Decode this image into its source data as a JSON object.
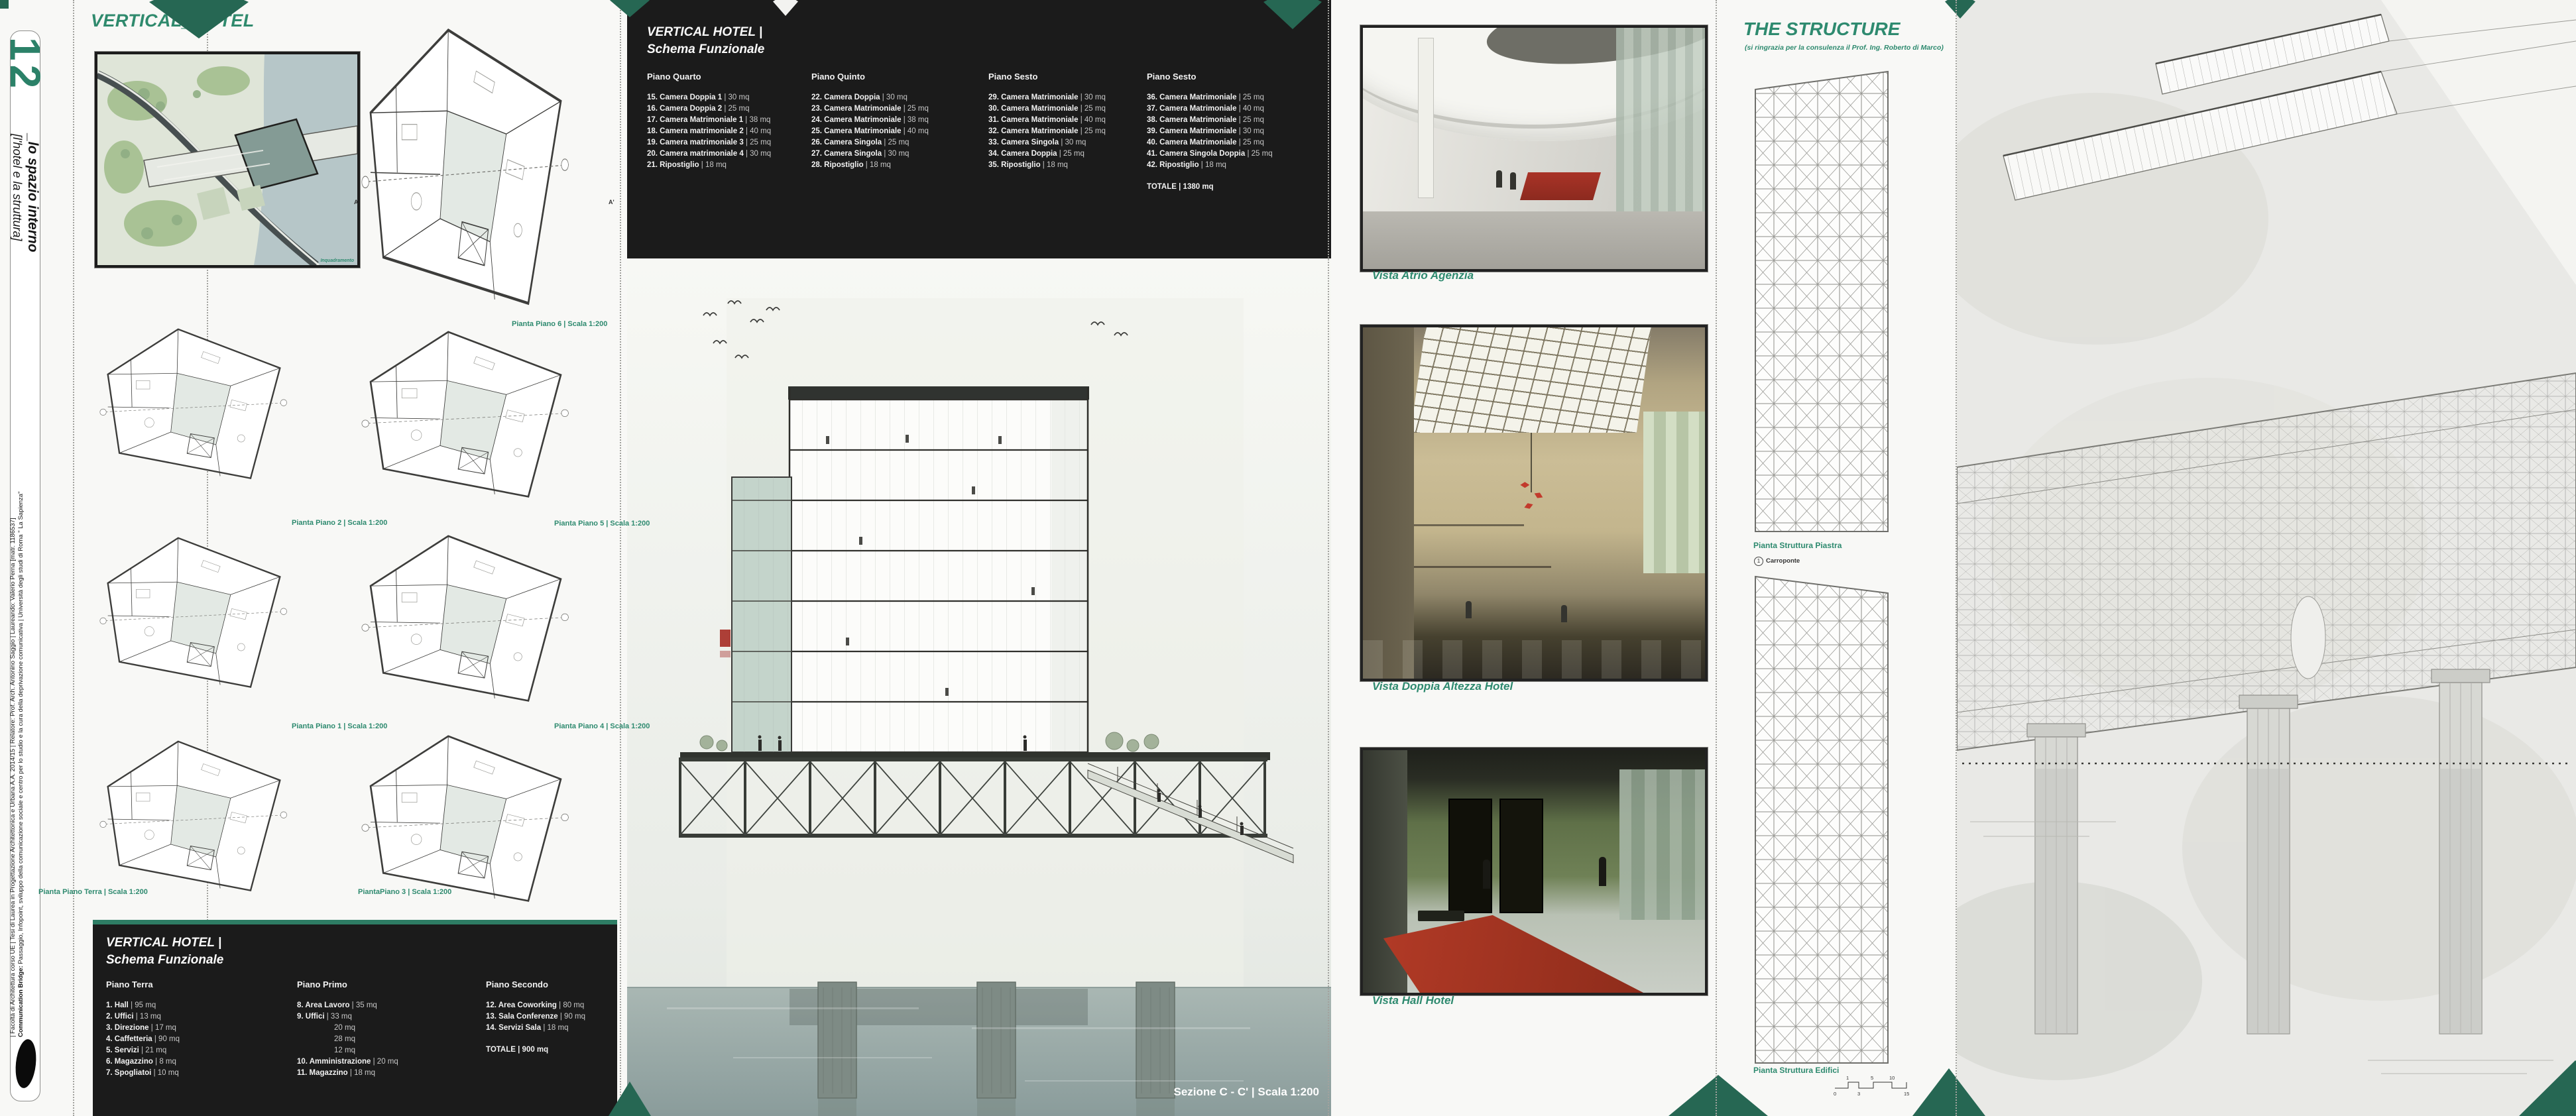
{
  "accent": {
    "green": "#2e8a6f",
    "dark_green": "#266753",
    "panel_black": "#1b1b1b"
  },
  "sidebar": {
    "number": "12",
    "series_title": "_lo spazio interno",
    "series_subtitle": "[l'hotel e la struttura]",
    "credit_bold": "Communication Bridge:",
    "credit_rest": " Passaggio, Infopoint, sviluppo della comunicazione sociale e centro per lo studio e la cura della deprivazione comunicativa | Università degli studi di Roma \" La Sapienza\"",
    "credit_line2": "| Facoltà di Architettura corso UE | Tesi di Laurea in Progettazione Architettonica e Urbana A.A. 2014/15 | Relatore: Prof. Arch. Antonino Saggio | Laureando: Valerio Perna [matr. 1186537]"
  },
  "header": {
    "title": "VERTICAL_HOTEL"
  },
  "plans": {
    "site_label": "Inquadramento",
    "section_marker_a": "A",
    "section_marker_a2": "A'",
    "labels": {
      "p6": "Pianta Piano 6 | Scala 1:200",
      "p5": "Pianta Piano 5 | Scala 1:200",
      "p4": "Pianta Piano 4 | Scala 1:200",
      "p3": "PiantaPiano 3 | Scala 1:200",
      "p2": "Pianta Piano 2 | Scala 1:200",
      "p1": "Pianta Piano 1 | Scala 1:200",
      "terra": "Pianta Piano Terra | Scala 1:200"
    }
  },
  "schema_upper": {
    "title1": "VERTICAL HOTEL |",
    "title2": "Schema Funzionale",
    "c1": {
      "header": "Piano Quarto",
      "items": [
        {
          "n": "15. Camera Doppia 1",
          "a": "| 30 mq"
        },
        {
          "n": "16. Camera Doppia 2",
          "a": "| 25 mq"
        },
        {
          "n": "17. Camera Matrimoniale 1",
          "a": "| 38 mq"
        },
        {
          "n": "18. Camera matrimoniale 2",
          "a": "| 40 mq"
        },
        {
          "n": "19. Camera matrimoniale 3",
          "a": "| 25 mq"
        },
        {
          "n": "20. Camera matrimoniale 4",
          "a": "| 30 mq"
        },
        {
          "n": "21. Ripostiglio",
          "a": "| 18 mq"
        }
      ]
    },
    "c2": {
      "header": "Piano Quinto",
      "items": [
        {
          "n": "22. Camera Doppia",
          "a": "| 30 mq"
        },
        {
          "n": "23. Camera Matrimoniale",
          "a": "| 25 mq"
        },
        {
          "n": "24. Camera Matrimoniale",
          "a": "| 38 mq"
        },
        {
          "n": "25. Camera Matrimoniale",
          "a": "| 40 mq"
        },
        {
          "n": "26. Camera Singola",
          "a": "| 25 mq"
        },
        {
          "n": "27. Camera Singola",
          "a": "| 30 mq"
        },
        {
          "n": "28. Ripostiglio",
          "a": "| 18 mq"
        }
      ]
    },
    "c3": {
      "header": "Piano Sesto",
      "items": [
        {
          "n": "29. Camera Matrimoniale",
          "a": "| 30 mq"
        },
        {
          "n": "30. Camera Matrimoniale",
          "a": "| 25 mq"
        },
        {
          "n": "31. Camera Matrimoniale",
          "a": "| 40 mq"
        },
        {
          "n": "32. Camera Matrimoniale",
          "a": "| 25 mq"
        },
        {
          "n": "33. Camera Singola",
          "a": "| 30 mq"
        },
        {
          "n": "34. Camera Doppia",
          "a": "| 25 mq"
        },
        {
          "n": "35. Ripostiglio",
          "a": "| 18 mq"
        }
      ]
    },
    "c4": {
      "header": "Piano Sesto",
      "items": [
        {
          "n": "36. Camera Matrimoniale",
          "a": "| 25 mq"
        },
        {
          "n": "37. Camera Matrimoniale",
          "a": "| 40 mq"
        },
        {
          "n": "38. Camera Matrimoniale",
          "a": "| 25 mq"
        },
        {
          "n": "39. Camera Matrimoniale",
          "a": "| 30 mq"
        },
        {
          "n": "40. Camera Matrimoniale",
          "a": "| 25 mq"
        },
        {
          "n": "41. Camera Singola Doppia",
          "a": "| 25 mq"
        },
        {
          "n": "42. Ripostiglio",
          "a": "| 18 mq"
        }
      ]
    },
    "totale": {
      "n": "TOTALE",
      "a": "| 1380 mq"
    }
  },
  "schema_lower": {
    "title1": "VERTICAL HOTEL |",
    "title2": "Schema Funzionale",
    "c1": {
      "header": "Piano Terra",
      "items": [
        {
          "n": "1. Hall",
          "a": "| 95 mq"
        },
        {
          "n": "2. Uffici",
          "a": "| 13 mq"
        },
        {
          "n": "3. Direzione",
          "a": "| 17 mq"
        },
        {
          "n": "4. Caffetteria",
          "a": "| 90 mq"
        },
        {
          "n": "5. Servizi",
          "a": "| 21 mq"
        },
        {
          "n": "6. Magazzino",
          "a": "| 8 mq"
        },
        {
          "n": "7. Spogliatoi",
          "a": "| 10 mq"
        }
      ]
    },
    "c2": {
      "header": "Piano Primo",
      "items": [
        {
          "n": "8. Area Lavoro",
          "a": "| 35 mq"
        },
        {
          "n": "9. Uffici",
          "a": "| 33 mq"
        },
        {
          "n": "",
          "a": "20 mq"
        },
        {
          "n": "",
          "a": "28 mq"
        },
        {
          "n": "",
          "a": "12 mq"
        },
        {
          "n": "10. Amministrazione",
          "a": "| 20 mq"
        },
        {
          "n": "11. Magazzino",
          "a": "| 18 mq"
        }
      ]
    },
    "c3": {
      "header": "Piano Secondo",
      "items": [
        {
          "n": "12. Area Coworking",
          "a": "| 80 mq"
        },
        {
          "n": "13. Sala Conferenze",
          "a": "| 90 mq"
        },
        {
          "n": "14. Servizi Sala",
          "a": "| 18 mq"
        }
      ]
    },
    "totale": {
      "n": "TOTALE",
      "a": "| 900 mq"
    }
  },
  "section": {
    "caption": "Sezione C - C' | Scala 1:200"
  },
  "renders": {
    "cap1": "Vista Atrio Agenzia",
    "cap2": "Vista Doppia Altezza Hotel",
    "cap3": "Vista Hall Hotel"
  },
  "structure": {
    "title": "THE STRUCTURE",
    "subtitle": "(si ringrazia per la consulenza il Prof. Ing. Roberto di Marco)",
    "label_piastra": "Pianta Struttura Piastra",
    "legend_num": "1",
    "legend_text": "Carroponte",
    "label_edifici": "Pianta Struttura Edifici",
    "scalebar": {
      "t1": "1",
      "t2": "5",
      "t3": "10",
      "b1": "0",
      "b2": "3",
      "b3": "15"
    }
  }
}
